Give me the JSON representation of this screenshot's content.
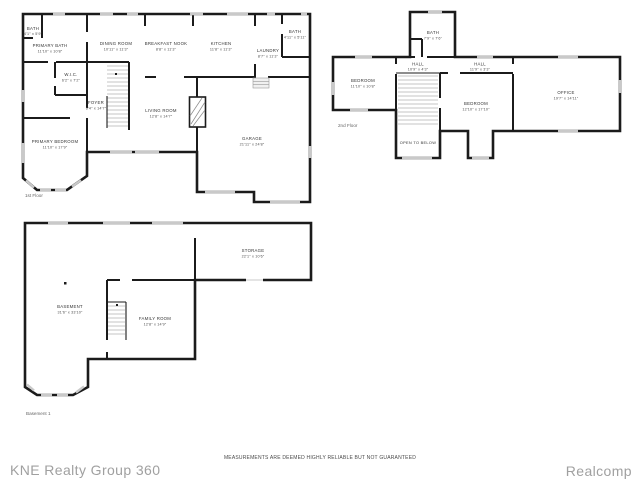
{
  "colors": {
    "wall": "#1b1b1b",
    "window": "#c9c9c9",
    "brand_gray": "#a0a0a0"
  },
  "footer": {
    "left_brand": "KNE Realty Group 360",
    "disclaimer": "MEASUREMENTS ARE DEEMED HIGHLY RELIABLE BUT NOT GUARANTEED",
    "right_brand": "Realcomp"
  },
  "floor1": {
    "caption": "1st Floor",
    "rooms": {
      "bath1": {
        "name": "BATH",
        "dims": "4'1\" x 5'9\""
      },
      "primary_bath": {
        "name": "PRIMARY BATH",
        "dims": "11'10\" x 10'8\""
      },
      "wic": {
        "name": "W.I.C.",
        "dims": "6'2\" x 7'2\""
      },
      "dining": {
        "name": "DINING ROOM",
        "dims": "10'11\" x 11'3\""
      },
      "breakfast": {
        "name": "BREAKFAST NOOK",
        "dims": "8'8\" x 11'3\""
      },
      "kitchen": {
        "name": "KITCHEN",
        "dims": "11'8\" x 11'3\""
      },
      "laundry": {
        "name": "LAUNDRY",
        "dims": "8'7\" x 11'3\""
      },
      "bath2": {
        "name": "BATH",
        "dims": "4'11\" x 5'11\""
      },
      "foyer": {
        "name": "FOYER",
        "dims": "6'4\" x 14'7\""
      },
      "living": {
        "name": "LIVING ROOM",
        "dims": "12'8\" x 14'7\""
      },
      "primary_bedroom": {
        "name": "PRIMARY BEDROOM",
        "dims": "11'10\" x 17'9\""
      },
      "garage": {
        "name": "GARAGE",
        "dims": "21'11\" x 24'8\""
      }
    }
  },
  "floor2": {
    "caption": "2nd Floor",
    "open_label": "OPEN TO BELOW",
    "rooms": {
      "bath": {
        "name": "BATH",
        "dims": "7'9\" x 7'6\""
      },
      "hall_a": {
        "name": "HALL",
        "dims": "10'9\" x 4'3\""
      },
      "hall_b": {
        "name": "HALL",
        "dims": "11'9\" x 3'3\""
      },
      "bedroom_a": {
        "name": "BEDROOM",
        "dims": "11'10\" x 10'8\""
      },
      "bedroom_b": {
        "name": "BEDROOM",
        "dims": "12'10\" x 17'10\""
      },
      "office": {
        "name": "OFFICE",
        "dims": "19'7\" x 14'11\""
      }
    }
  },
  "basement": {
    "caption": "Basement 1",
    "rooms": {
      "storage": {
        "name": "STORAGE",
        "dims": "22'1\" x 10'6\""
      },
      "basement": {
        "name": "BASEMENT",
        "dims": "31'6\" x 33'10\""
      },
      "family": {
        "name": "FAMILY ROOM",
        "dims": "12'8\" x 14'9\""
      }
    }
  }
}
